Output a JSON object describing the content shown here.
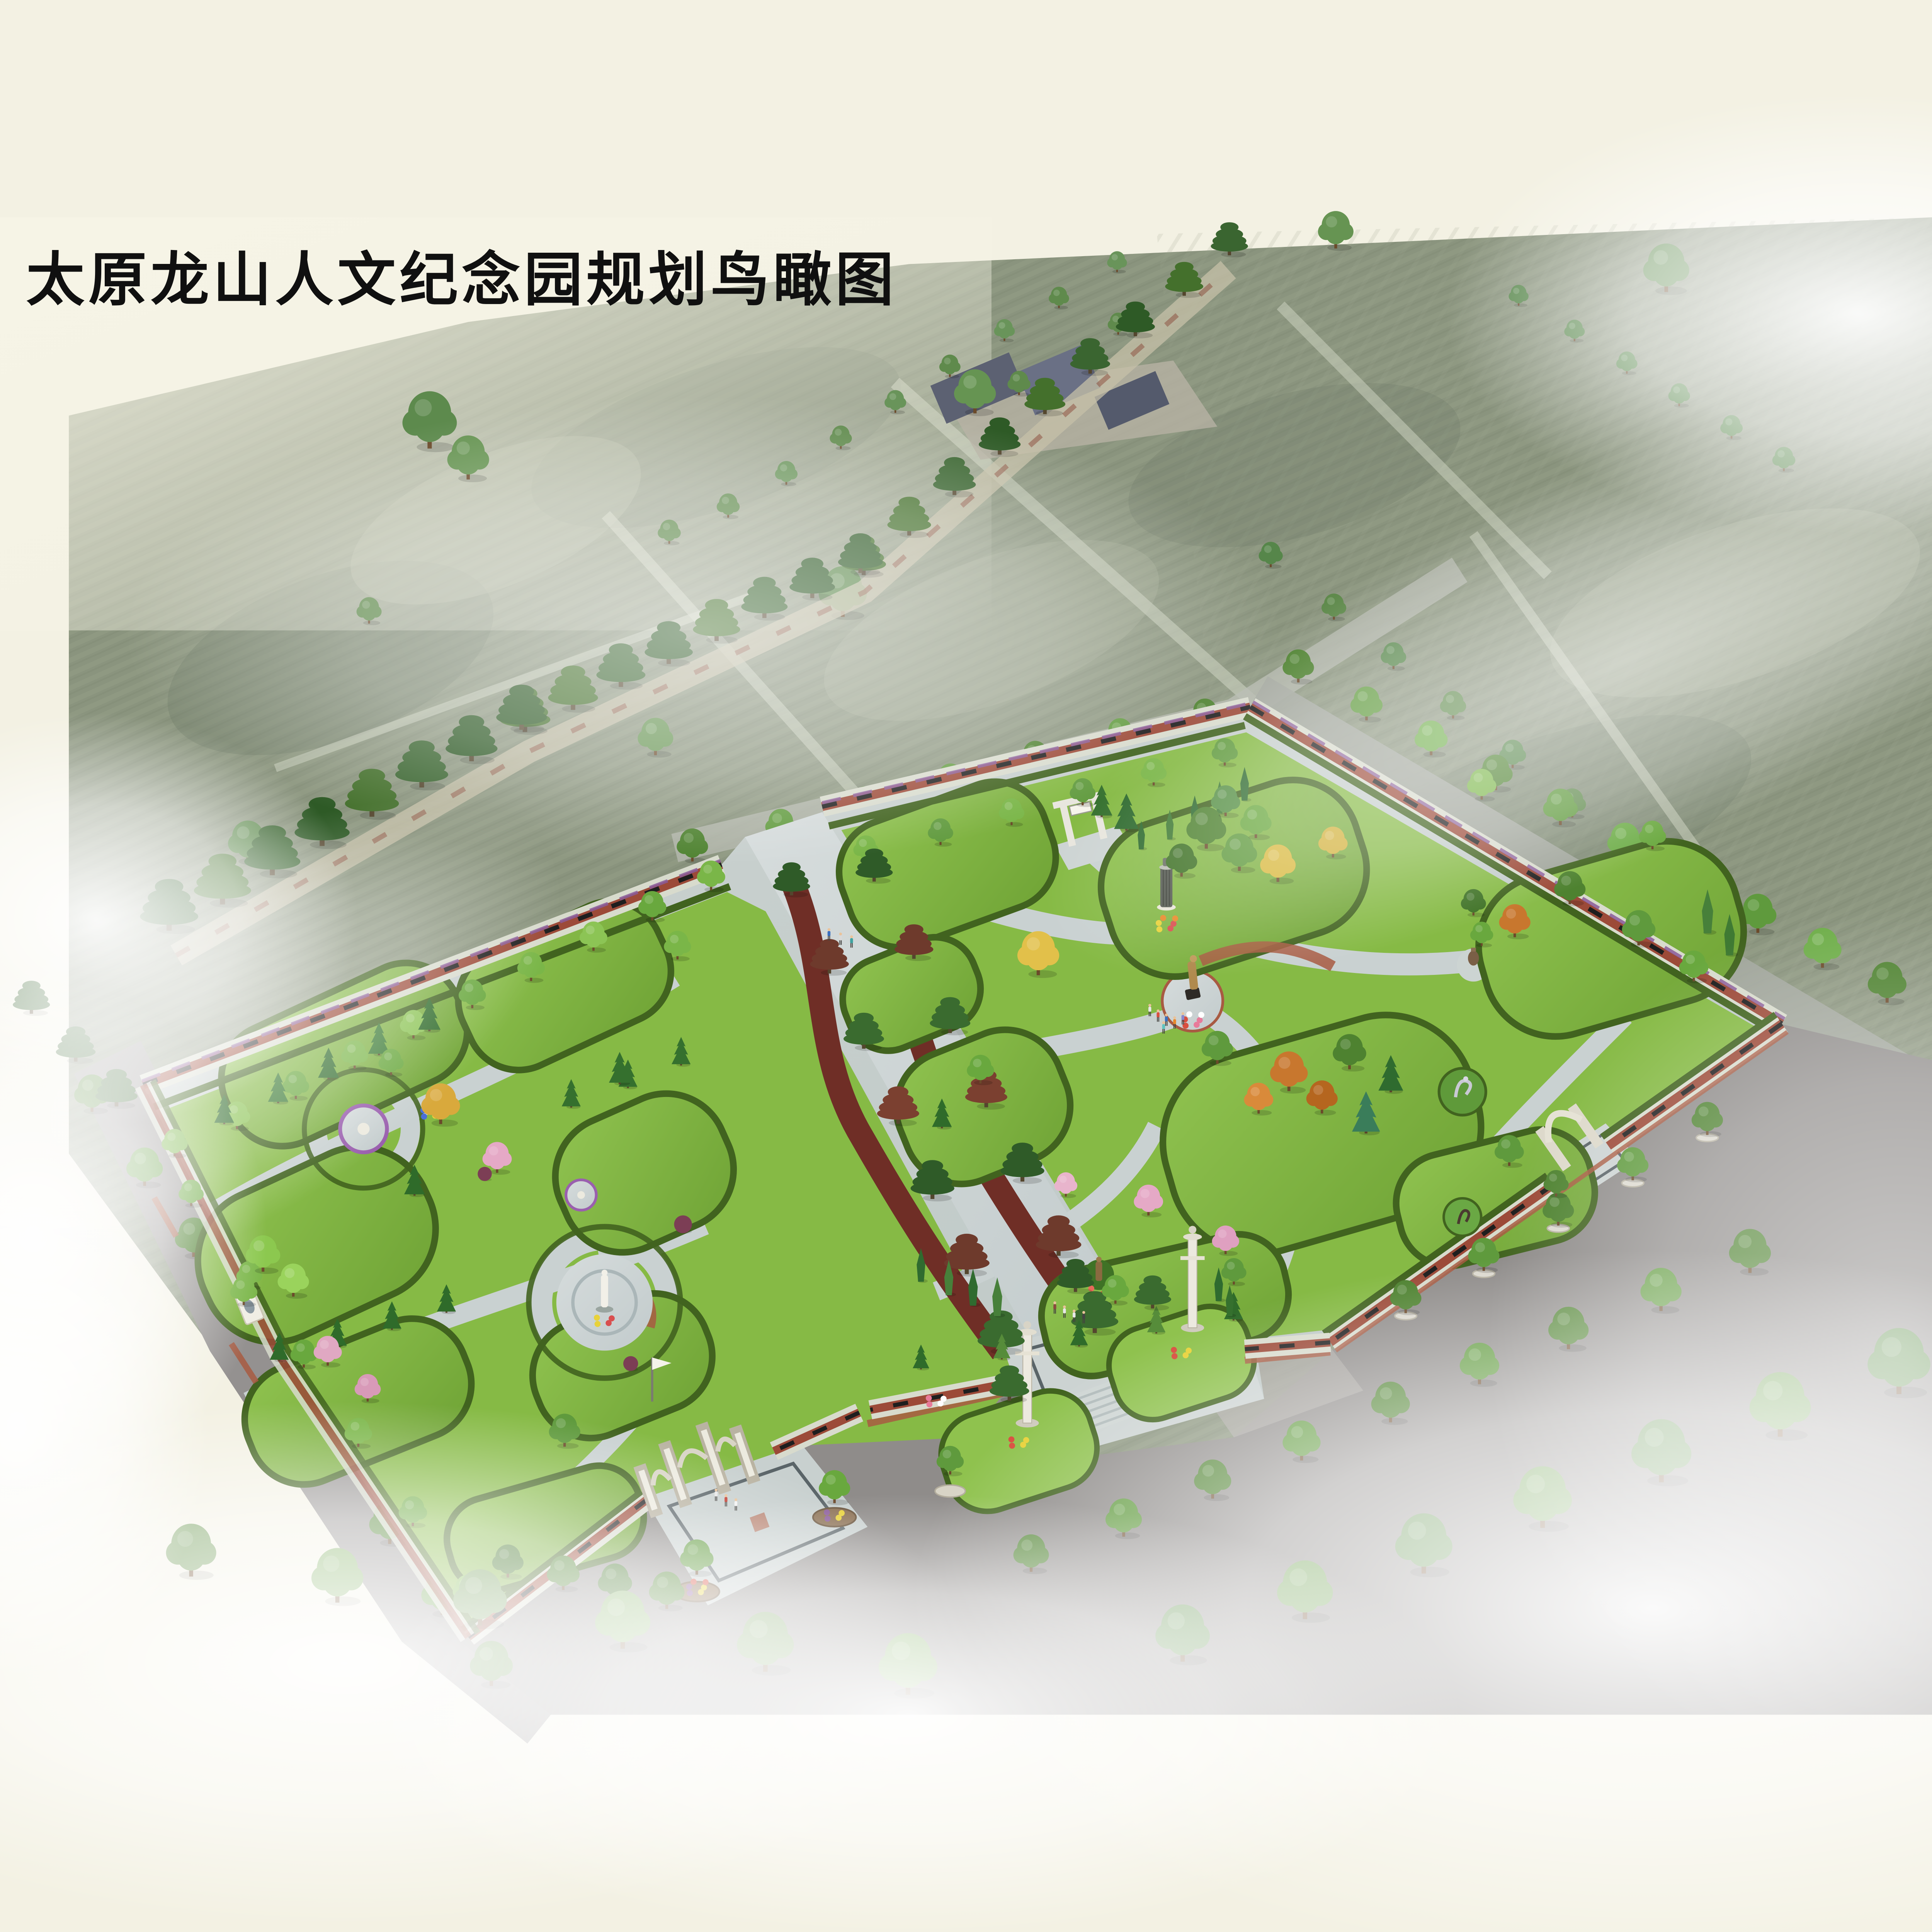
{
  "title": {
    "text": "太原龙山人文纪念园规划鸟瞰图"
  },
  "palette": {
    "bg": "#f3f1e3",
    "field": "#8a947e",
    "field_light": "#a7b099",
    "mist": "#ffffff",
    "lawn": "#82b742",
    "hedge": "#41631f",
    "paving": "#c9d1d1",
    "brick": "#9c4a38",
    "plaque": "#1e1e1e",
    "road": "#8f8c8a",
    "axisbed": "#6f2e26",
    "title": "#101010"
  },
  "features": [
    {
      "name": "background-cemetery-fields"
    },
    {
      "name": "diagonal-pine-avenue"
    },
    {
      "name": "memorial-plaque-walls"
    },
    {
      "name": "central-axis-boulevard"
    },
    {
      "name": "main-entrance-huabiao-columns"
    },
    {
      "name": "paifang-gate"
    },
    {
      "name": "stone-pillar-gates"
    },
    {
      "name": "statue-plazas"
    },
    {
      "name": "column-monument"
    },
    {
      "name": "street-tree-rows"
    },
    {
      "name": "fog-overlays"
    }
  ]
}
